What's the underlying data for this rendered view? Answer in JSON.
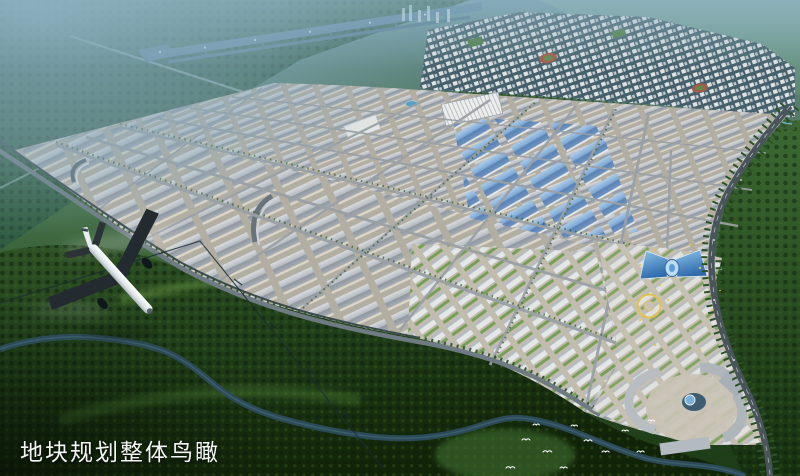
{
  "caption": {
    "text": "地块规划整体鸟瞰"
  },
  "palette": {
    "haze": "#85a9b8",
    "forest_dark": "#16280f",
    "forest_mid": "#2e5224",
    "forest_light": "#5d8f3c",
    "ground": "#b3aea2",
    "roof_gray": "#9aa1a8",
    "roof_light": "#d6d9dc",
    "wall": "#ddd6c6",
    "roof_blue": "#6f9cc8",
    "glass_blue": "#3f7fc1",
    "road": "#9aa0a5",
    "asphalt": "#49545b",
    "river": "#2c4a57",
    "runway": "#5e83a0",
    "residential_base": "#45606a",
    "accent_yellow": "#e0c34e",
    "track_red": "#a55a4b",
    "white": "#f4f6f5"
  },
  "scene_elements": [
    "sky-haze",
    "airport-runway",
    "residential-district",
    "canal",
    "industrial-park",
    "warehouse-rows",
    "blue-roof-warehouses",
    "mixed-use-blocks",
    "white-factory",
    "arc-building",
    "street-grid",
    "boundary-road",
    "ring-highway",
    "commercial-center",
    "glass-butterfly-building",
    "circular-plaza",
    "mall-complex",
    "river",
    "transmission-line",
    "forest",
    "airplane",
    "birds",
    "caption"
  ]
}
